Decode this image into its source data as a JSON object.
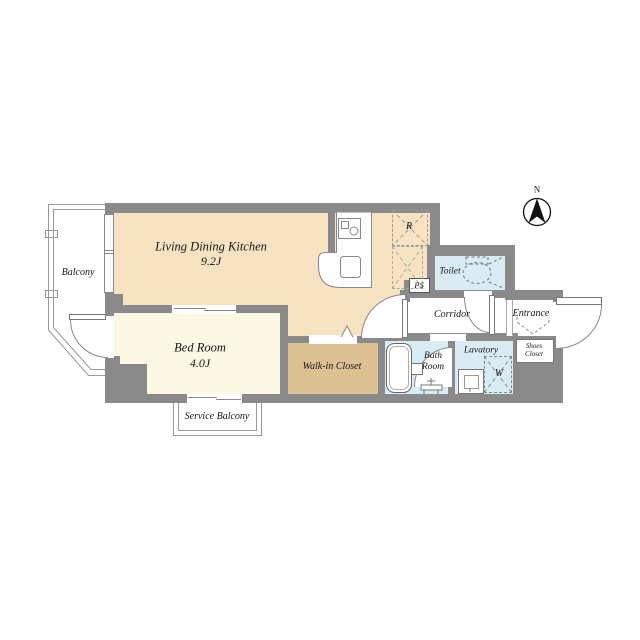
{
  "rooms": {
    "ldk": {
      "label": "Living Dining Kitchen",
      "area": "9.2J"
    },
    "bedroom": {
      "label": "Bed Room",
      "area": "4.0J"
    },
    "balcony": {
      "label": "Balcony"
    },
    "service_balcony": {
      "label": "Service Balcony"
    },
    "walk_in_closet": {
      "label": "Walk-in Closet"
    },
    "toilet": {
      "label": "Toilet"
    },
    "corridor": {
      "label": "Corridor"
    },
    "entrance": {
      "label": "Entrance"
    },
    "shoes_closet": {
      "line1": "Shoes",
      "line2": "Closet"
    },
    "bath_room": {
      "line1": "Bath",
      "line2": "Room"
    },
    "lavatory": {
      "label": "Lavatory"
    },
    "pipe_space": {
      "label": "PS"
    },
    "refrigerator_space": {
      "label": "R"
    },
    "washer_space": {
      "label": "W"
    }
  },
  "compass": {
    "north_label": "N"
  },
  "colors": {
    "wall": "#8a8a8a",
    "ldk_fill": "#f7e3c2",
    "bedroom_fill": "#fcf8e3",
    "closet_fill": "#dcc193",
    "wet_fill": "#d9ecf4",
    "line": "#777777"
  }
}
